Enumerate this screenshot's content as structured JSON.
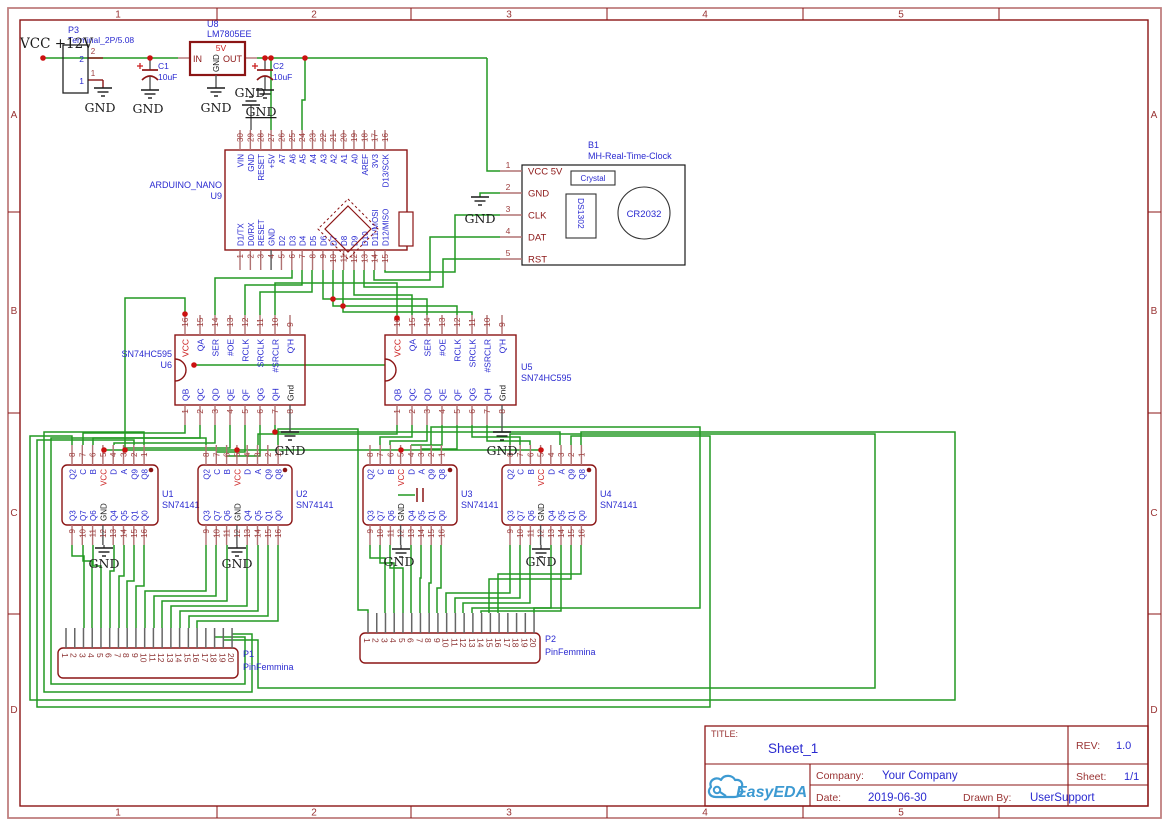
{
  "sheet": {
    "columns": [
      "1",
      "2",
      "3",
      "4",
      "5"
    ],
    "rows": [
      "A",
      "B",
      "C",
      "D"
    ]
  },
  "title_block": {
    "title_label": "TITLE:",
    "title": "Sheet_1",
    "rev_label": "REV:",
    "rev": "1.0",
    "company_label": "Company:",
    "company": "Your Company",
    "sheet_label": "Sheet:",
    "sheet": "1/1",
    "date_label": "Date:",
    "date": "2019-06-30",
    "drawn_label": "Drawn By:",
    "drawn_by": "UserSupport",
    "logo_text": "EasyEDA"
  },
  "net_labels": {
    "gnd": "GND",
    "vcc12": "VCC +12V"
  },
  "colors": {
    "wire_green": "#229922",
    "outline_maroon": "#8b1515",
    "label_blue": "#2a2ad0",
    "vcc_red": "#cc2222",
    "junction_red": "#cc1111",
    "logo_blue": "#3d9ad2",
    "frame_light": "#c08080",
    "frame_label": "#993333"
  },
  "components": {
    "P3": {
      "ref": "P3",
      "value": "Terminal_2P/5.08",
      "pin_numbers": [
        "2",
        "1"
      ]
    },
    "C1": {
      "ref": "C1",
      "value": "10uF"
    },
    "C2": {
      "ref": "C2",
      "value": "10uF"
    },
    "U8": {
      "ref": "U8",
      "value": "LM7805EE",
      "pin_in": "IN",
      "pin_gnd": "GND",
      "pin_out": "OUT",
      "pin_5v": "5V"
    },
    "U9": {
      "ref": "U9",
      "value": "ARDUINO_NANO",
      "top_numbers": [
        "30",
        "29",
        "28",
        "27",
        "26",
        "25",
        "24",
        "23",
        "22",
        "21",
        "20",
        "19",
        "18",
        "17",
        "16"
      ],
      "top_names": [
        "VIN",
        "GND",
        "RESET",
        "+5V",
        "A7",
        "A6",
        "A5",
        "A4",
        "A3",
        "A2",
        "A1",
        "A0",
        "AREF",
        "3V3",
        "D13/SCK"
      ],
      "bottom_numbers": [
        "1",
        "2",
        "3",
        "4",
        "5",
        "6",
        "7",
        "8",
        "9",
        "10",
        "11",
        "12",
        "13",
        "14",
        "15"
      ],
      "bottom_names": [
        "D1/TX",
        "D0/RX",
        "RESET",
        "GND",
        "D2",
        "D3",
        "D4",
        "D5",
        "D6",
        "D7",
        "D8",
        "D9",
        "D10",
        "D11/MOSI",
        "D12/MISO"
      ]
    },
    "B1": {
      "ref": "B1",
      "value": "MH-Real-Time-Clock",
      "pins": [
        {
          "num": "1",
          "name": "VCC 5V"
        },
        {
          "num": "2",
          "name": "GND"
        },
        {
          "num": "3",
          "name": "CLK"
        },
        {
          "num": "4",
          "name": "DAT"
        },
        {
          "num": "5",
          "name": "RST"
        }
      ],
      "crystal": "Crystal",
      "chip": "DS1302",
      "battery": "CR2032"
    },
    "U6": {
      "ref": "U6",
      "value": "SN74HC595",
      "top_numbers": [
        "16",
        "15",
        "14",
        "13",
        "12",
        "11",
        "10",
        "9"
      ],
      "top_names": [
        "VCC",
        "QA",
        "SER",
        "#OE",
        "RCLK",
        "SRCLK",
        "#SRCLR",
        "Q'H"
      ],
      "bottom_numbers": [
        "1",
        "2",
        "3",
        "4",
        "5",
        "6",
        "7",
        "8"
      ],
      "bottom_names": [
        "QB",
        "QC",
        "QD",
        "QE",
        "QF",
        "QG",
        "QH",
        "Gnd"
      ]
    },
    "U5": {
      "ref": "U5",
      "value": "SN74HC595",
      "top_numbers": [
        "16",
        "15",
        "14",
        "13",
        "12",
        "11",
        "10",
        "9"
      ],
      "top_names": [
        "VCC",
        "QA",
        "SER",
        "#OE",
        "RCLK",
        "SRCLK",
        "#SRCLR",
        "Q'H"
      ],
      "bottom_numbers": [
        "1",
        "2",
        "3",
        "4",
        "5",
        "6",
        "7",
        "8"
      ],
      "bottom_names": [
        "QB",
        "QC",
        "QD",
        "QE",
        "QF",
        "QG",
        "QH",
        "Gnd"
      ]
    },
    "U1": {
      "ref": "U1",
      "value": "SN74141",
      "top_numbers": [
        "8",
        "7",
        "6",
        "5",
        "4",
        "3",
        "2",
        "1"
      ],
      "top_names": [
        "Q2",
        "C",
        "B",
        "VCC",
        "D",
        "A",
        "Q9",
        "Q8"
      ],
      "bottom_numbers": [
        "9",
        "10",
        "11",
        "12",
        "13",
        "14",
        "15",
        "16"
      ],
      "bottom_names": [
        "Q3",
        "Q7",
        "Q6",
        "GND",
        "Q4",
        "Q5",
        "Q1",
        "Q0"
      ]
    },
    "U2": {
      "ref": "U2",
      "value": "SN74141",
      "top_numbers": [
        "8",
        "7",
        "6",
        "5",
        "4",
        "3",
        "2",
        "1"
      ],
      "top_names": [
        "Q2",
        "C",
        "B",
        "VCC",
        "D",
        "A",
        "Q9",
        "Q8"
      ],
      "bottom_numbers": [
        "9",
        "10",
        "11",
        "12",
        "13",
        "14",
        "15",
        "16"
      ],
      "bottom_names": [
        "Q3",
        "Q7",
        "Q6",
        "GND",
        "Q4",
        "Q5",
        "Q1",
        "Q0"
      ]
    },
    "U3": {
      "ref": "U3",
      "value": "SN74141",
      "top_numbers": [
        "8",
        "7",
        "6",
        "5",
        "4",
        "3",
        "2",
        "1"
      ],
      "top_names": [
        "Q2",
        "C",
        "B",
        "VCC",
        "D",
        "A",
        "Q9",
        "Q8"
      ],
      "bottom_numbers": [
        "9",
        "10",
        "11",
        "12",
        "13",
        "14",
        "15",
        "16"
      ],
      "bottom_names": [
        "Q3",
        "Q7",
        "Q6",
        "GND",
        "Q4",
        "Q5",
        "Q1",
        "Q0"
      ]
    },
    "U4": {
      "ref": "U4",
      "value": "SN74141",
      "top_numbers": [
        "8",
        "7",
        "6",
        "5",
        "4",
        "3",
        "2",
        "1"
      ],
      "top_names": [
        "Q2",
        "C",
        "B",
        "VCC",
        "D",
        "A",
        "Q9",
        "Q8"
      ],
      "bottom_numbers": [
        "9",
        "10",
        "11",
        "12",
        "13",
        "14",
        "15",
        "16"
      ],
      "bottom_names": [
        "Q3",
        "Q7",
        "Q6",
        "GND",
        "Q4",
        "Q5",
        "Q1",
        "Q0"
      ]
    },
    "P1": {
      "ref": "P1",
      "value": "PinFemmina",
      "pins": [
        "1",
        "2",
        "3",
        "4",
        "5",
        "6",
        "7",
        "8",
        "9",
        "10",
        "11",
        "12",
        "13",
        "14",
        "15",
        "16",
        "17",
        "18",
        "19",
        "20"
      ]
    },
    "P2": {
      "ref": "P2",
      "value": "PinFemmina",
      "pins": [
        "1",
        "2",
        "3",
        "4",
        "5",
        "6",
        "7",
        "8",
        "9",
        "10",
        "11",
        "12",
        "13",
        "14",
        "15",
        "16",
        "17",
        "18",
        "19",
        "20"
      ]
    }
  }
}
